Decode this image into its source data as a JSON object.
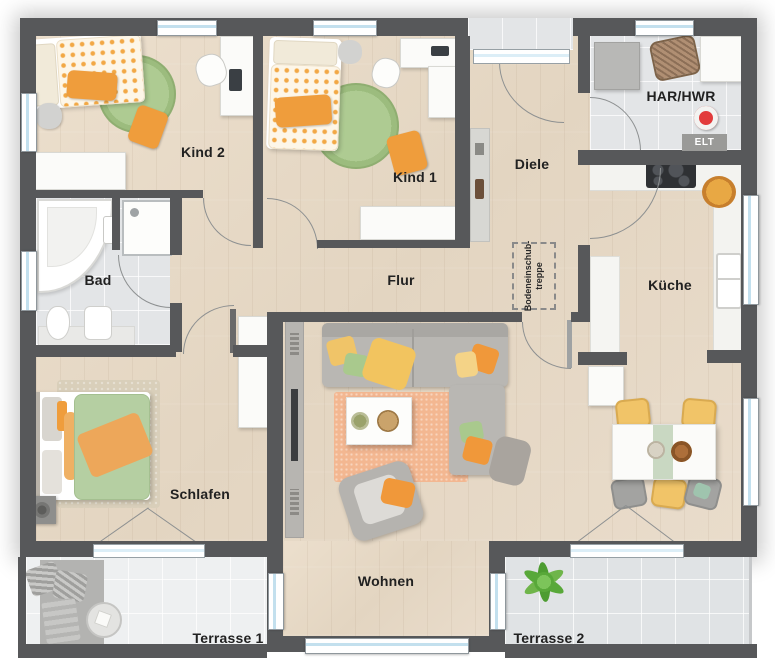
{
  "rooms": {
    "kind2": {
      "label": "Kind 2"
    },
    "kind1": {
      "label": "Kind 1"
    },
    "diele": {
      "label": "Diele"
    },
    "har_hwr": {
      "label": "HAR/HWR"
    },
    "bad": {
      "label": "Bad"
    },
    "flur": {
      "label": "Flur"
    },
    "kueche": {
      "label": "Küche"
    },
    "schlafen": {
      "label": "Schlafen"
    },
    "wohnen": {
      "label": "Wohnen"
    },
    "terrasse1": {
      "label": "Terrasse 1"
    },
    "terrasse2": {
      "label": "Terrasse 2"
    }
  },
  "annotations": {
    "elt": {
      "label": "ELT"
    },
    "attic_stair": {
      "line1": "Bodeneinschub-",
      "line2": "treppe"
    }
  },
  "colors": {
    "wall": "#57585a",
    "wood": "#e8dcc9",
    "tile": "#e3e5e7",
    "accent_orange": "#ef9d3c",
    "accent_green": "#a9c98d",
    "accent_yellow": "#f0c468",
    "rug_peach": "#f3b791"
  }
}
